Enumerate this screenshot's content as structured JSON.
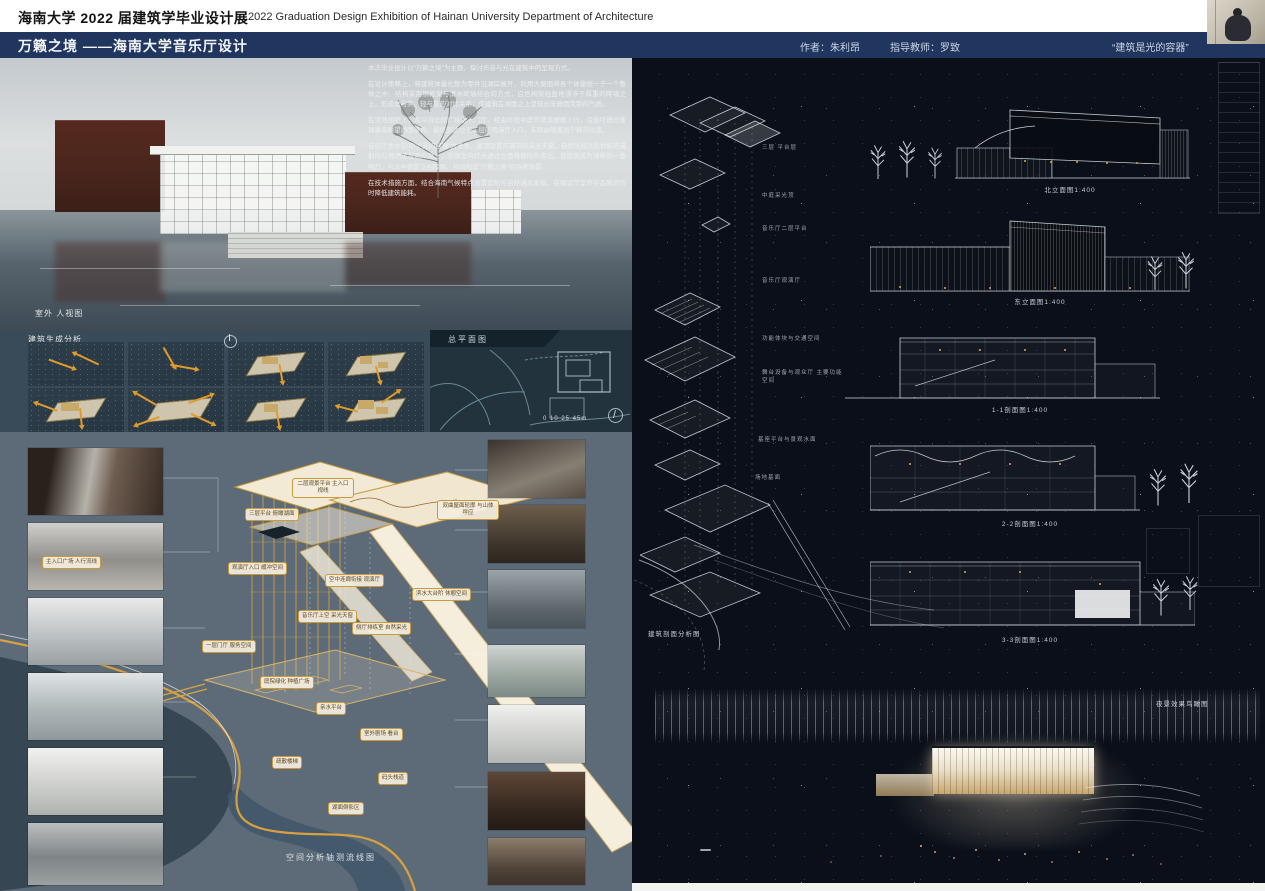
{
  "header": {
    "school_title": "海南大学 2022 届建筑学毕业设计展",
    "exhibition_title_en": "2022 Graduation Design Exhibition of Hainan University Department of Architecture"
  },
  "titlebar": {
    "project_title": "万籁之境 ——海南大学音乐厅设计",
    "author": "作者：朱利昂",
    "advisor": "指导教师：罗致",
    "quote": "“建筑是光的容器”"
  },
  "left_panel": {
    "view_label": "室外 人视图",
    "gen_label": "建筑生成分析",
    "site_label": "总平面图",
    "scale_text": "0  10 25  45m",
    "flow_label": "空间分析轴测流线图",
    "description_paragraphs": [
      "本次毕业设计以“万籁之境”为主题，探讨声音与光在建筑中的呈现方式。",
      "在设计策略上，将建筑体量化整为零并沿湖岸展开，利用大屋面将各个体量统一于一个整体之中。结构采用钢框架与清水砖墙结合的方式，白色构架轻盈地漂浮于厚重的砖墙之上，形成虚与实、轻与重的对比关系，使建筑在湖面之上呈现出安静而克制的气质。",
      "在流线组织上，观众自北侧广场进入门厅，经由环绕中庭的坡道缓缓上行，沿途可透过玻璃幕墙眺望湖面景色，最终到达位于二层的观演厅入口，实现由喧嚣到宁静的过渡。",
      "音乐厅主体空间以“光的容器”为意象，屋顶设置可调节的采光天窗，自然光经过反射板的漫射均匀地洒落在观众席上；夜晚室内灯光透过立面格栅向外渗出，使建筑成为湖畔的一盏明灯，与水中倒影交相辉映，共同构成“万籁之境”的诗意场景。",
      "在技术措施方面，结合海南气候特点设置遮阳与自然通风系统，在保证厅堂声学品质的同时降低建筑能耗。"
    ],
    "callouts": [
      "二层观景平台 主入口视线",
      "双曲屋面轮廓 与山体呼应",
      "三层平台 俯瞰湖面",
      "观演厅入口 缓冲空间",
      "空中连廊衔接 观演厅",
      "音乐厅上空 采光天窗",
      "侧厅排练室 自然采光",
      "滨水大台阶 休憩空间",
      "主入口广场 人行流线",
      "一层门厅 服务空间",
      "庭院绿化 种植广场",
      "亲水平台",
      "室外剧场 看台",
      "疏散楼梯",
      "码头栈道",
      "湖面倒影区"
    ]
  },
  "right_panel": {
    "exploded_labels": [
      "三层 平台层",
      "中庭采光顶",
      "音乐厅二层平台",
      "音乐厅观演厅",
      "功能体块与交通空间",
      "舞台设备与观众厅 主要功能空间",
      "基座平台与景观水面",
      "场地基面"
    ],
    "drawings": [
      {
        "label": "北立面图1:400"
      },
      {
        "label": "东立面图1:400"
      },
      {
        "label": "1-1剖面图1:400"
      },
      {
        "label": "2-2剖面图1:400"
      },
      {
        "label": "3-3剖面图1:400"
      }
    ],
    "section_analysis_label": "建筑剖面分析图",
    "night_label": "夜景效果鸟瞰图"
  },
  "colors": {
    "navy": "#20365f",
    "gold": "#d9a43f",
    "slate": "#5d6b78",
    "dark": "#0a0f19"
  }
}
